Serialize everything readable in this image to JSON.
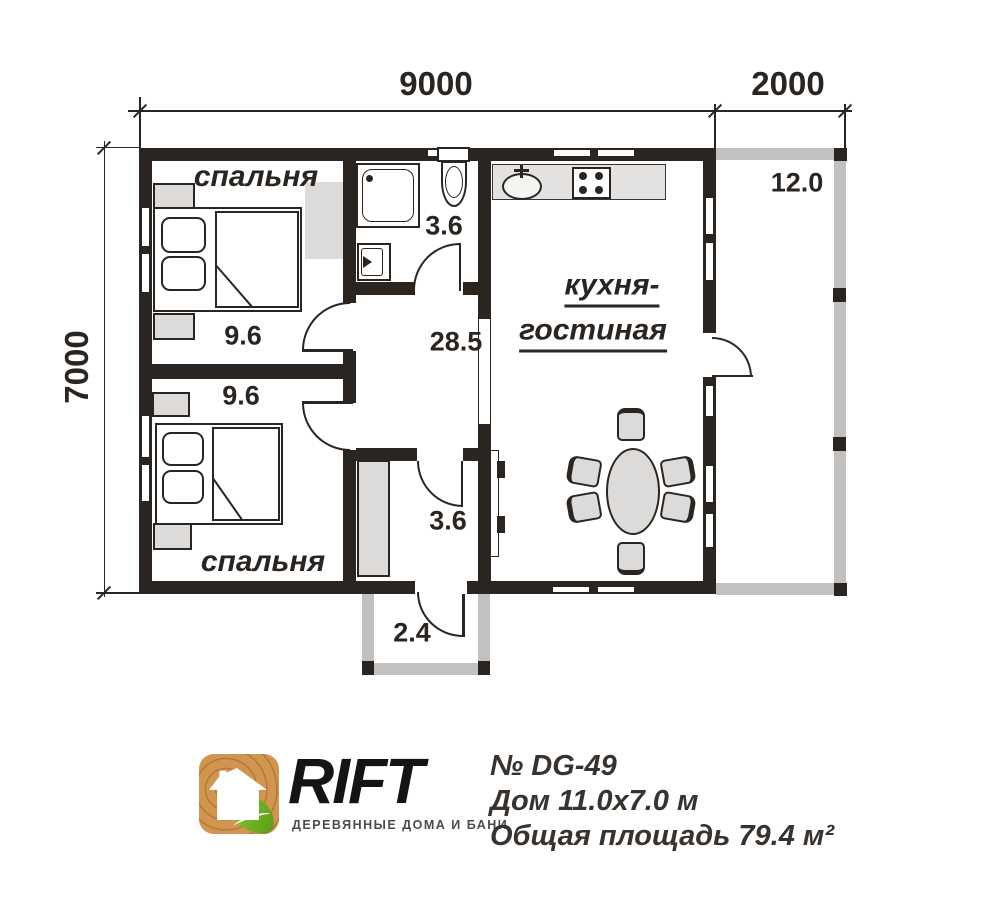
{
  "plan": {
    "dim_width_main": "9000",
    "dim_width_terrace": "2000",
    "dim_height": "7000",
    "bedroom_top": {
      "name": "спальня",
      "area": "9.6"
    },
    "bedroom_bottom": {
      "name": "спальня",
      "area": "9.6"
    },
    "bathroom_area": "3.6",
    "hall_area": "28.5",
    "dressing_area": "3.6",
    "porch_area": "2.4",
    "terrace_area": "12.0",
    "kitchen_living_line1": "кухня-",
    "kitchen_living_line2": "гостиная"
  },
  "footer": {
    "brand": "RIFT",
    "tagline": "ДЕРЕВЯННЫЕ ДОМА И БАНИ",
    "model": "№ DG-49",
    "size": "Дом 11.0х7.0 м",
    "total_area": "Общая площадь 79.4 м²"
  },
  "colors": {
    "line": "#2a2521",
    "light_wall": "#c2c1bf",
    "furniture": "#dcdbd9",
    "counter": "#e3e2e0",
    "logo_wood": "#d1954f",
    "logo_leaf": "#76b82a"
  }
}
